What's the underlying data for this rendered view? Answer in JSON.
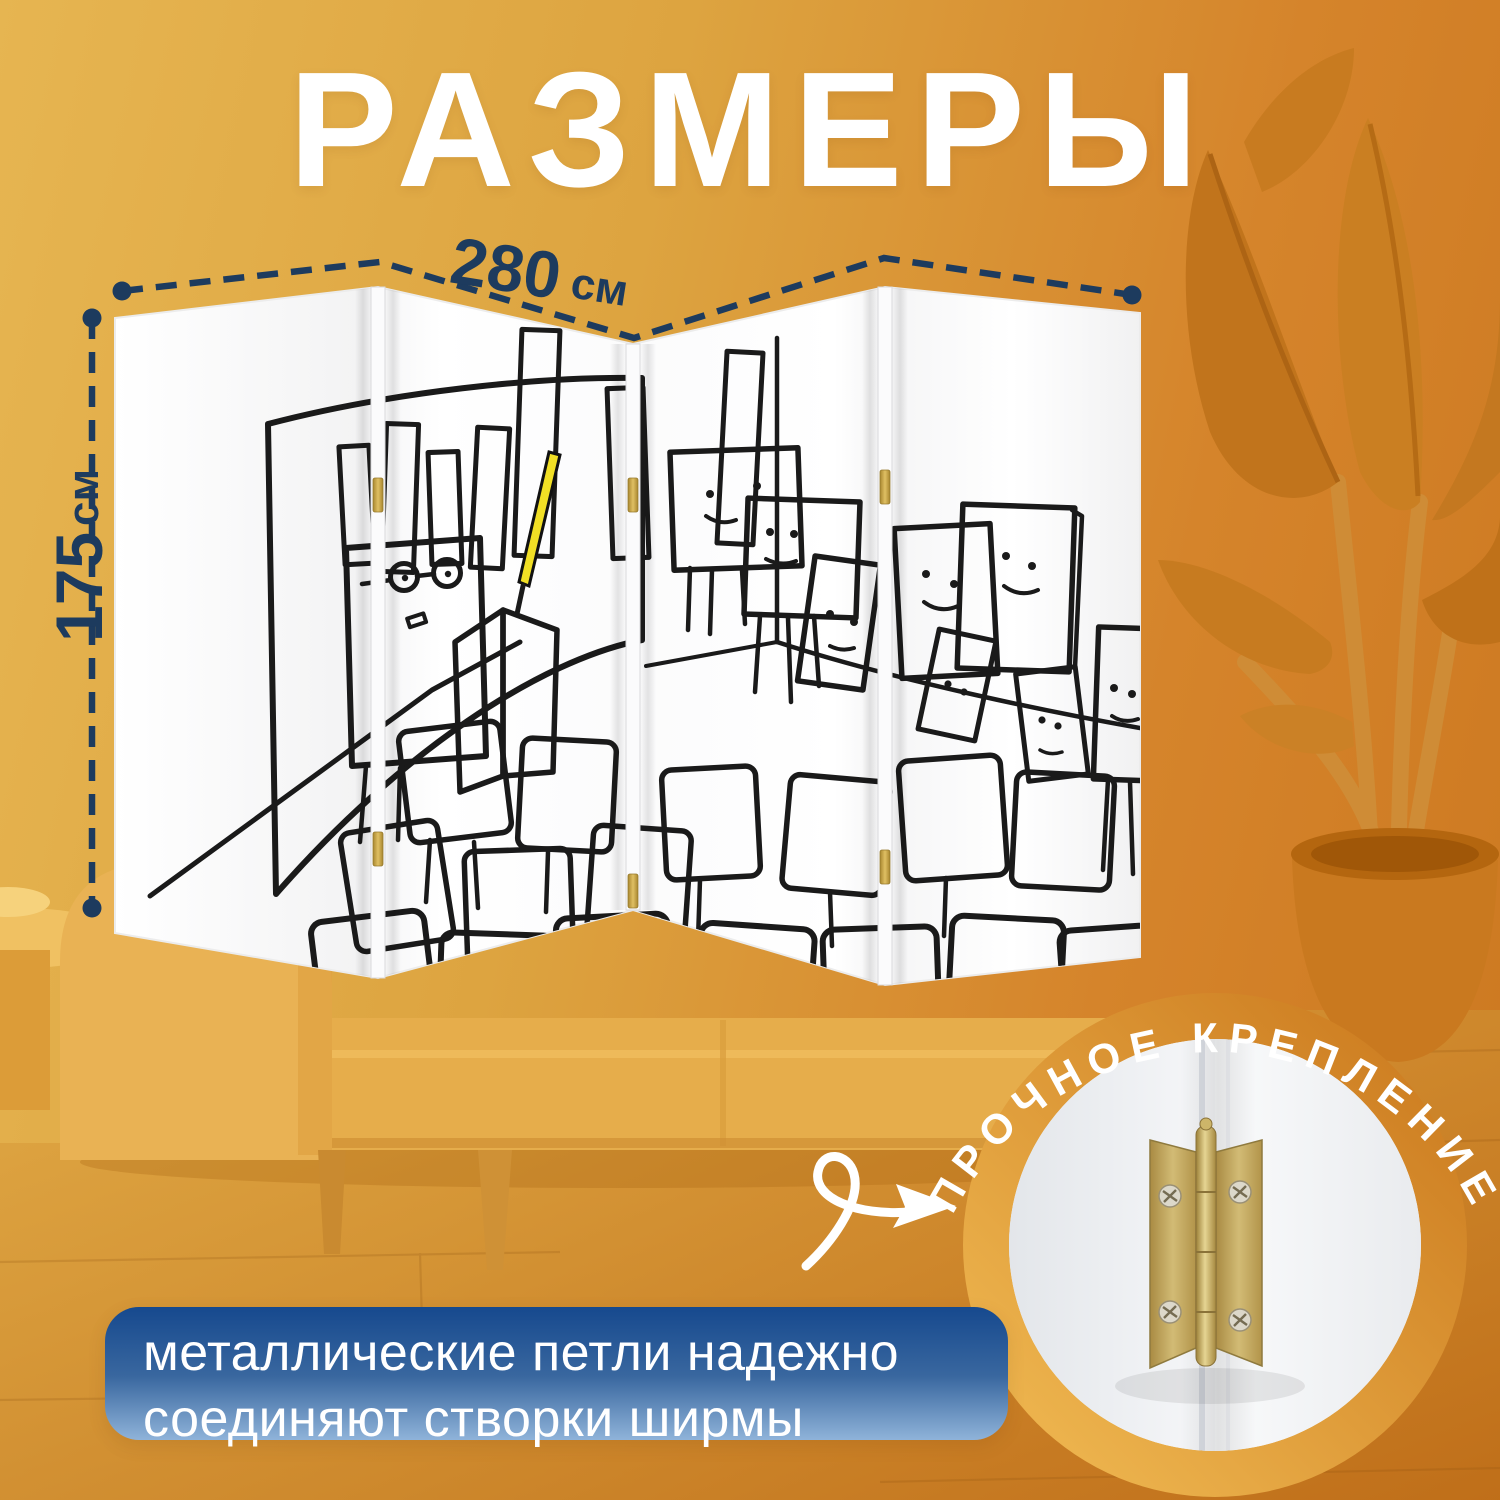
{
  "title": "РАЗМЕРЫ",
  "dimensions": {
    "width": {
      "value": "280",
      "unit": "см"
    },
    "height": {
      "value": "175",
      "ununit": "",
      "unit": "см"
    }
  },
  "screen": {
    "panel_count": 4,
    "artwork_alt": "cartoon classroom of square characters with presenter, bar chart and teal podium"
  },
  "hinge_badge": {
    "label": "ПРОЧНОЕ КРЕПЛЕНИЕ"
  },
  "info_box": {
    "line1": "металлические петли надежно",
    "line2": "соединяют створки ширмы"
  },
  "colors": {
    "background_left": "#e6b551",
    "background_right": "#cc7820",
    "dimension_navy": "#1d3b5e",
    "info_box_top": "#16498e",
    "info_box_bottom": "#8fb3d9",
    "accent_teal": "#a5dacf",
    "pointer_yellow": "#f1df25",
    "hinge_brass": "#b9973f"
  }
}
